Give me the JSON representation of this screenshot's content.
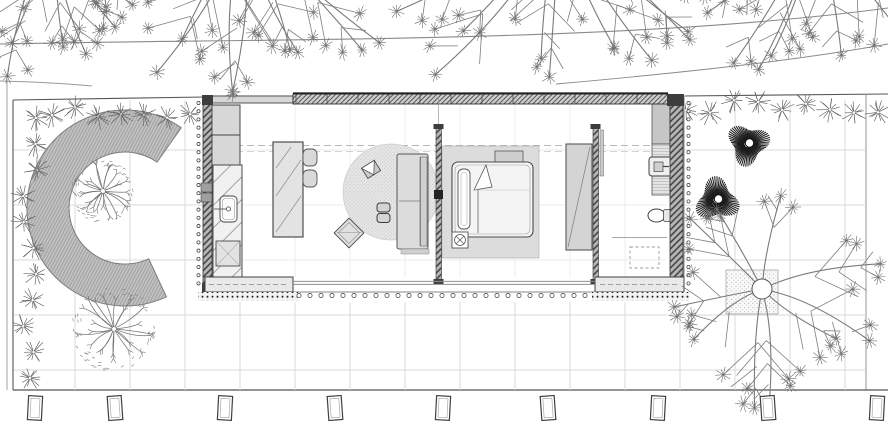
{
  "meta": {
    "title": "single-storey-house-site-plan",
    "drawing_type": "architectural site plan, top view, monochrome linework",
    "visible_text": []
  },
  "palette": {
    "paper": "#ffffff",
    "line_dark": "#333333",
    "line_mid": "#777777",
    "grid": "#d9d9d9",
    "fill_light": "#dcdcdc",
    "fill_mid": "#c6c6c6",
    "hedge_gray": "#adadad",
    "bush_dark": "#1d1d1d",
    "tree_stroke": "#747474"
  },
  "inventory": {
    "garden_features": [
      "curved-hedge",
      "ornamental-round-tree",
      "paving-grid",
      "dark-shrub-ball",
      "large-deciduous-tree",
      "tree-planter",
      "shrub-border",
      "fence-posts",
      "road-edge-lines",
      "overhanging-street-trees"
    ],
    "rooms": [
      {
        "name": "utility-kitchen",
        "furniture": [
          "storage-unit",
          "storage-unit",
          "kitchen-counter",
          "sink",
          "kitchen-island",
          "bar-stool",
          "bar-stool"
        ]
      },
      {
        "name": "living-area",
        "furniture": [
          "round-rug",
          "lounge-chair",
          "pouf",
          "pouf",
          "armchair-diagonal",
          "sofa"
        ]
      },
      {
        "name": "bedroom",
        "furniture": [
          "bed-platform",
          "double-bed",
          "pillow",
          "folded-sheet",
          "bedside-table-lamp",
          "head-bench",
          "wardrobe"
        ]
      },
      {
        "name": "bathroom",
        "furniture": [
          "tall-cabinet",
          "vanity-counter",
          "wall-sink",
          "duct",
          "toilet",
          "grab-rail",
          "shower-area-dashed",
          "sliding-door"
        ]
      }
    ]
  },
  "scene": {
    "canvas": {
      "w": 888,
      "h": 441
    },
    "grid": {
      "x_from": 75,
      "x_to": 845,
      "x_step": 55,
      "y_from": 150,
      "y_to": 370,
      "y_step": 55,
      "top": 100,
      "bottom": 390,
      "left": 14,
      "right": 866
    },
    "interior_grid": {
      "vxs": [
        295,
        350,
        405,
        460,
        515,
        570,
        625
      ],
      "y0": 104,
      "y1": 277,
      "hys": [
        150,
        205,
        260
      ],
      "x0": 214,
      "x1": 666
    },
    "round_trees": [
      {
        "cx": 103,
        "cy": 191,
        "r": 28,
        "seed": 3
      },
      {
        "cx": 114,
        "cy": 329,
        "r": 38,
        "seed": 13
      }
    ],
    "dark_bushes": [
      {
        "cx": 748,
        "cy": 144,
        "r": 23,
        "seed": 1
      },
      {
        "cx": 717,
        "cy": 200,
        "r": 24,
        "seed": 5
      }
    ],
    "big_tree": {
      "cx": 762,
      "cy": 289,
      "trunk_r": 10,
      "r": 118,
      "branches": 10,
      "seed": 9
    },
    "top_trees": [
      {
        "cx": 55,
        "cy": -70,
        "r": 150,
        "a0": 55,
        "a1": 125,
        "n": 6,
        "seed": 21
      },
      {
        "cx": 245,
        "cy": -75,
        "r": 190,
        "a0": 35,
        "a1": 145,
        "n": 9,
        "seed": 31
      },
      {
        "cx": 560,
        "cy": -85,
        "r": 205,
        "a0": 35,
        "a1": 145,
        "n": 9,
        "seed": 41
      },
      {
        "cx": 815,
        "cy": -80,
        "r": 165,
        "a0": 40,
        "a1": 140,
        "n": 7,
        "seed": 51
      }
    ],
    "shrub_rows": [
      {
        "axis": "x",
        "from": 52,
        "to": 204,
        "step": 23,
        "at": 112,
        "seed": 61
      },
      {
        "axis": "x",
        "from": 686,
        "to": 878,
        "step": 24,
        "at": 107,
        "seed": 71
      },
      {
        "axis": "y",
        "from": 118,
        "to": 386,
        "step": 26,
        "at": 30,
        "seed": 81
      }
    ],
    "fence_posts": {
      "xs": [
        35,
        115,
        225,
        335,
        443,
        548,
        658,
        768,
        877
      ],
      "y": 408,
      "w": 14,
      "h": 24
    },
    "dot_rows": [
      {
        "axis": "y",
        "at": 198.5,
        "from": 103,
        "to": 290,
        "step": 8.2,
        "r": 1.6
      },
      {
        "axis": "y",
        "at": 688.5,
        "from": 103,
        "to": 290,
        "step": 8.2,
        "r": 1.6
      },
      {
        "axis": "x",
        "at": 295.5,
        "from": 299,
        "to": 590,
        "step": 11,
        "r": 2.1
      }
    ],
    "mullions": {
      "from": 296,
      "to": 666,
      "step": 31,
      "y0": 94.5,
      "y1": 103.5
    },
    "planter": {
      "x": 726,
      "y": 270,
      "w": 52,
      "h": 44
    }
  }
}
